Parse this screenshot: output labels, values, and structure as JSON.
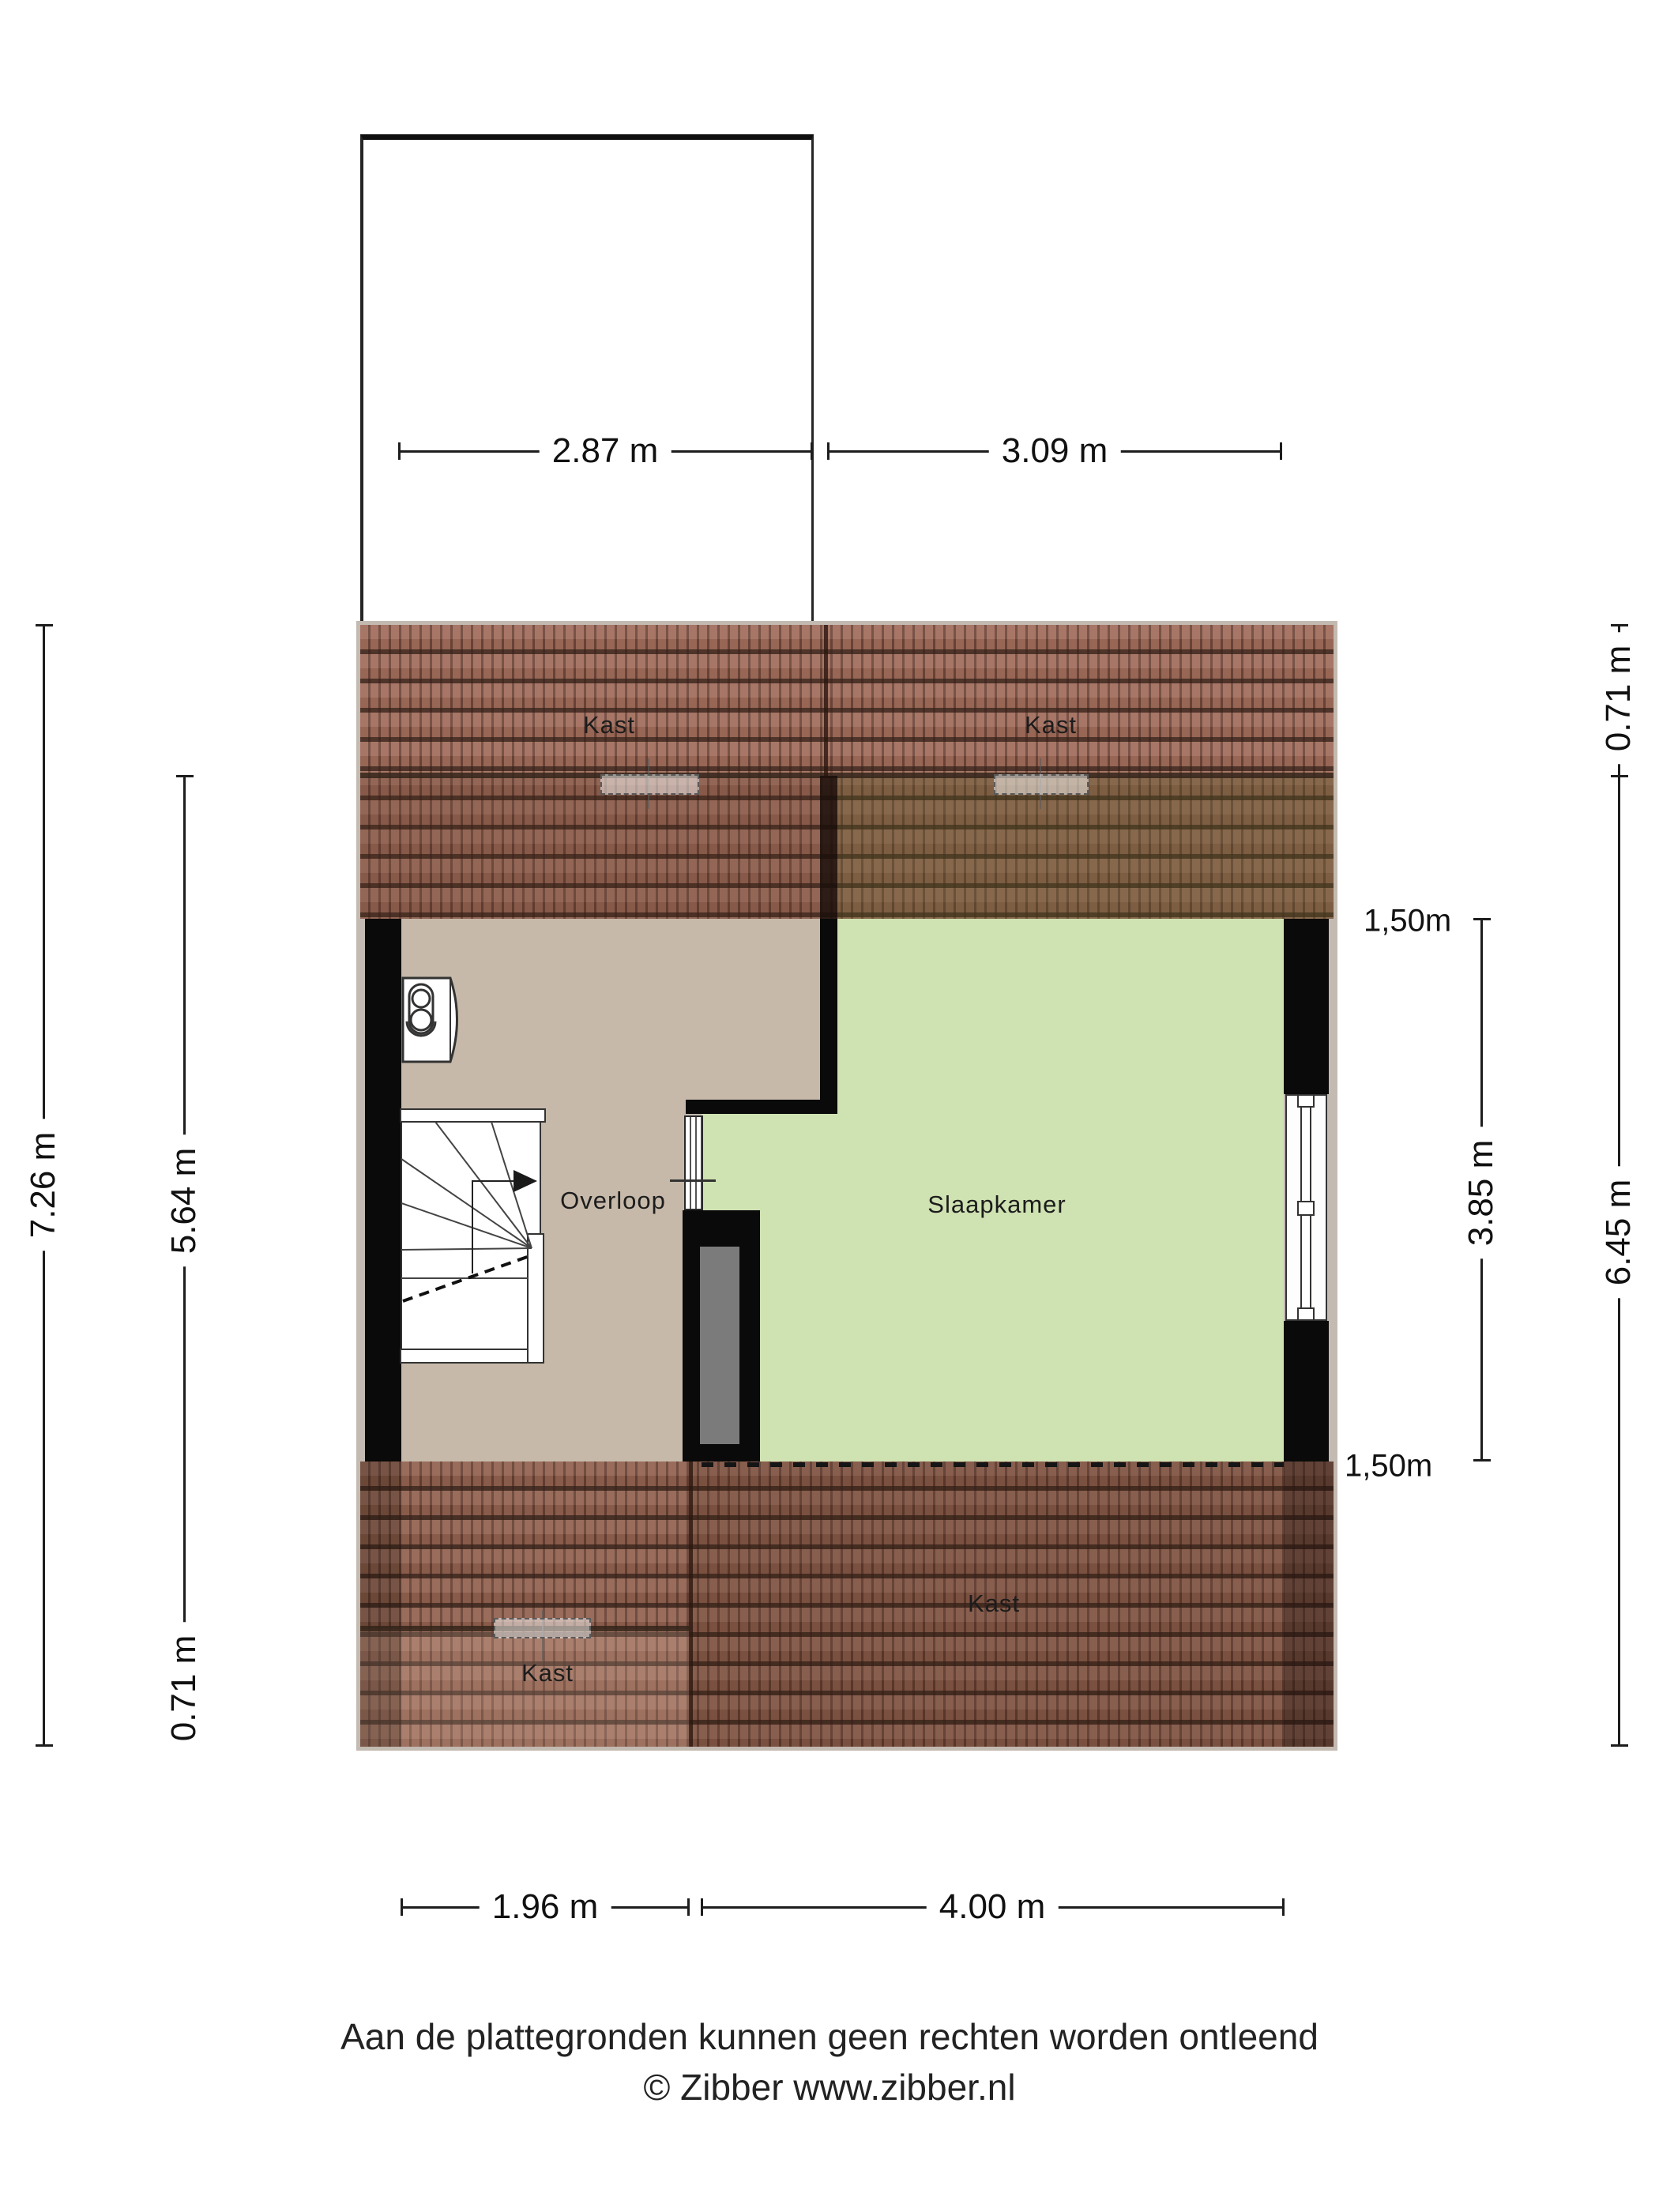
{
  "plan": {
    "rooms": {
      "kast_top_left": "Kast",
      "kast_top_right": "Kast",
      "kast_bottom_left": "Kast",
      "kast_bottom_right": "Kast",
      "overloop": "Overloop",
      "slaapkamer": "Slaapkamer"
    },
    "height_markers": {
      "top": "1,50m",
      "bottom": "1,50m"
    },
    "dimensions": {
      "dormer_width": "2.87 m",
      "roof_right_width": "3.09 m",
      "total_height_left": "7.26 m",
      "inner_height_left": "5.64 m",
      "eaves_bottom_left": "0.71 m",
      "eaves_top_right": "0.71 m",
      "right_height": "6.45 m",
      "bedroom_height": "3.85 m",
      "overloop_width": "1.96 m",
      "bedroom_width": "4.00 m"
    },
    "colors": {
      "floor_overloop": "#c6b9a9",
      "floor_slaapkamer": "#cfe2b2",
      "wall": "#0a0a0a",
      "roof_tile": "#a06c5a",
      "shaft": "#7b7b7b"
    }
  },
  "footer": {
    "disclaimer": "Aan de plattegronden kunnen geen rechten worden ontleend",
    "copyright": "© Zibber www.zibber.nl"
  }
}
